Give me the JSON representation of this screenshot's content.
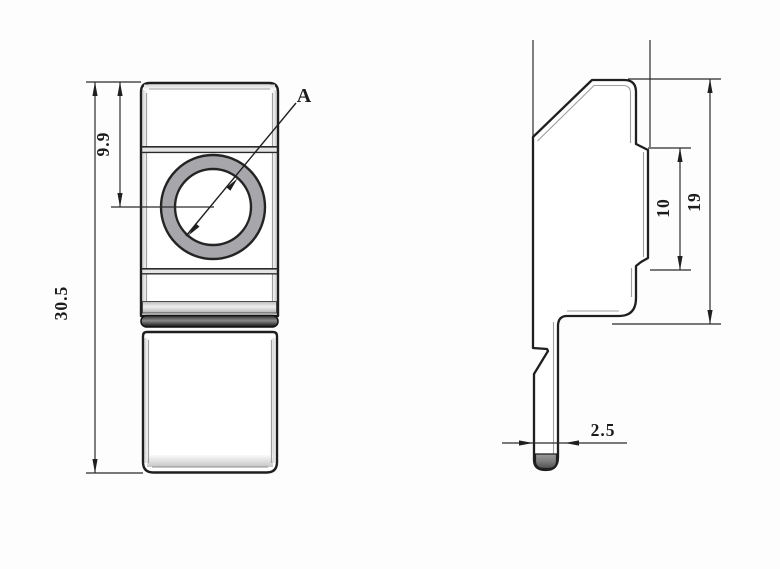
{
  "drawing": {
    "front_view": {
      "overall_height_label": "30.5",
      "hole_center_offset_label": "9.9",
      "hole_ref_label": "A"
    },
    "side_view": {
      "head_height_label": "19",
      "rib_height_label": "10",
      "stem_thickness_label": "2.5"
    }
  },
  "colors": {
    "line": "#1f1f1f",
    "thin_line": "#2b2b2b",
    "bevel_line": "#9f9f9f",
    "ring_fill": "#a7a7ab",
    "background": "#fdfdfd"
  }
}
